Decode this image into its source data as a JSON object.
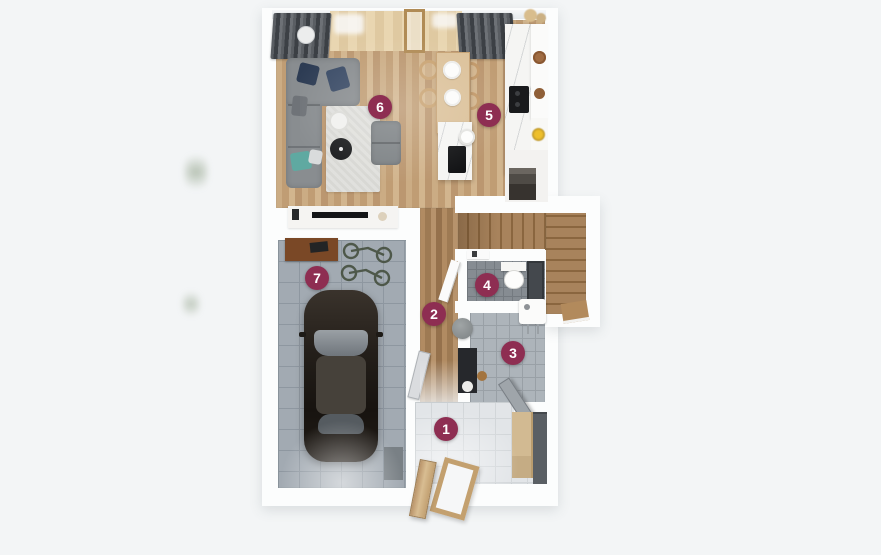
{
  "plan": {
    "marker_color": "#8e2e52",
    "marker_text_color": "#ffffff",
    "markers": [
      {
        "label": "1",
        "x": 446,
        "y": 429
      },
      {
        "label": "2",
        "x": 434,
        "y": 314
      },
      {
        "label": "3",
        "x": 513,
        "y": 353
      },
      {
        "label": "4",
        "x": 487,
        "y": 285
      },
      {
        "label": "5",
        "x": 489,
        "y": 115
      },
      {
        "label": "6",
        "x": 380,
        "y": 107
      },
      {
        "label": "7",
        "x": 317,
        "y": 278
      }
    ]
  }
}
